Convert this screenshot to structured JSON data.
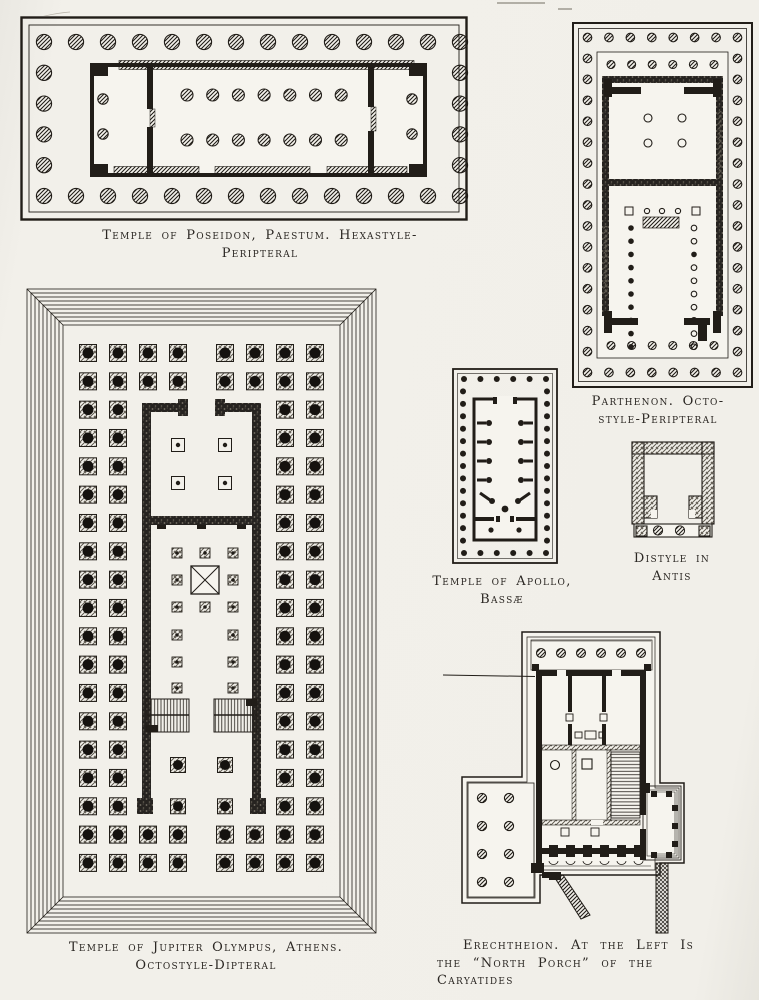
{
  "page": {
    "kind": "book-plate-of-greek-temple-plans",
    "paper_color": "#f1efe9",
    "ink_color": "#211d18"
  },
  "figures": {
    "poseidon": {
      "name": "Temple of Poseidon, Paestum",
      "caption_lines": [
        "Temple of Poseidon, Paestum. Hexastyle-",
        "Peripteral"
      ],
      "columns": {
        "front": 6,
        "flank": 14,
        "naos_rows": 2,
        "naos_per_row": 7,
        "porch_pairs": 2
      }
    },
    "parthenon": {
      "name": "Parthenon",
      "caption_lines": [
        "Parthenon. Octo-",
        "style-Peripteral"
      ],
      "columns": {
        "front": 8,
        "flank": 17,
        "inner_porch": 6,
        "west_room": 4,
        "naos_side": 10
      }
    },
    "apollo": {
      "name": "Temple of Apollo, Bassae",
      "caption_lines": [
        "Temple of Apollo,",
        "Bassæ"
      ],
      "columns": {
        "front": 6,
        "flank": 15,
        "spur_pairs": 4
      }
    },
    "distyle": {
      "name": "Distyle in Antis",
      "caption_lines": [
        "Distyle in",
        "Antis"
      ],
      "columns": {
        "in_antis": 2
      }
    },
    "jupiter": {
      "name": "Temple of Jupiter Olympus, Athens",
      "caption_lines": [
        "Temple of Jupiter Olympus, Athens.",
        "Octostyle-Dipteral"
      ],
      "columns": {
        "front": 8,
        "front_rows": 2,
        "flank_files": 2,
        "flank_rows": 15
      }
    },
    "erechtheion": {
      "name": "Erechtheion",
      "caption_lines": [
        "Erechtheion. At the Left Is",
        "the “North Porch” of the",
        "Caryatides"
      ],
      "columns": {
        "top_porch": 6,
        "left_porch": 8,
        "south_wall_engaged": 6
      }
    }
  }
}
